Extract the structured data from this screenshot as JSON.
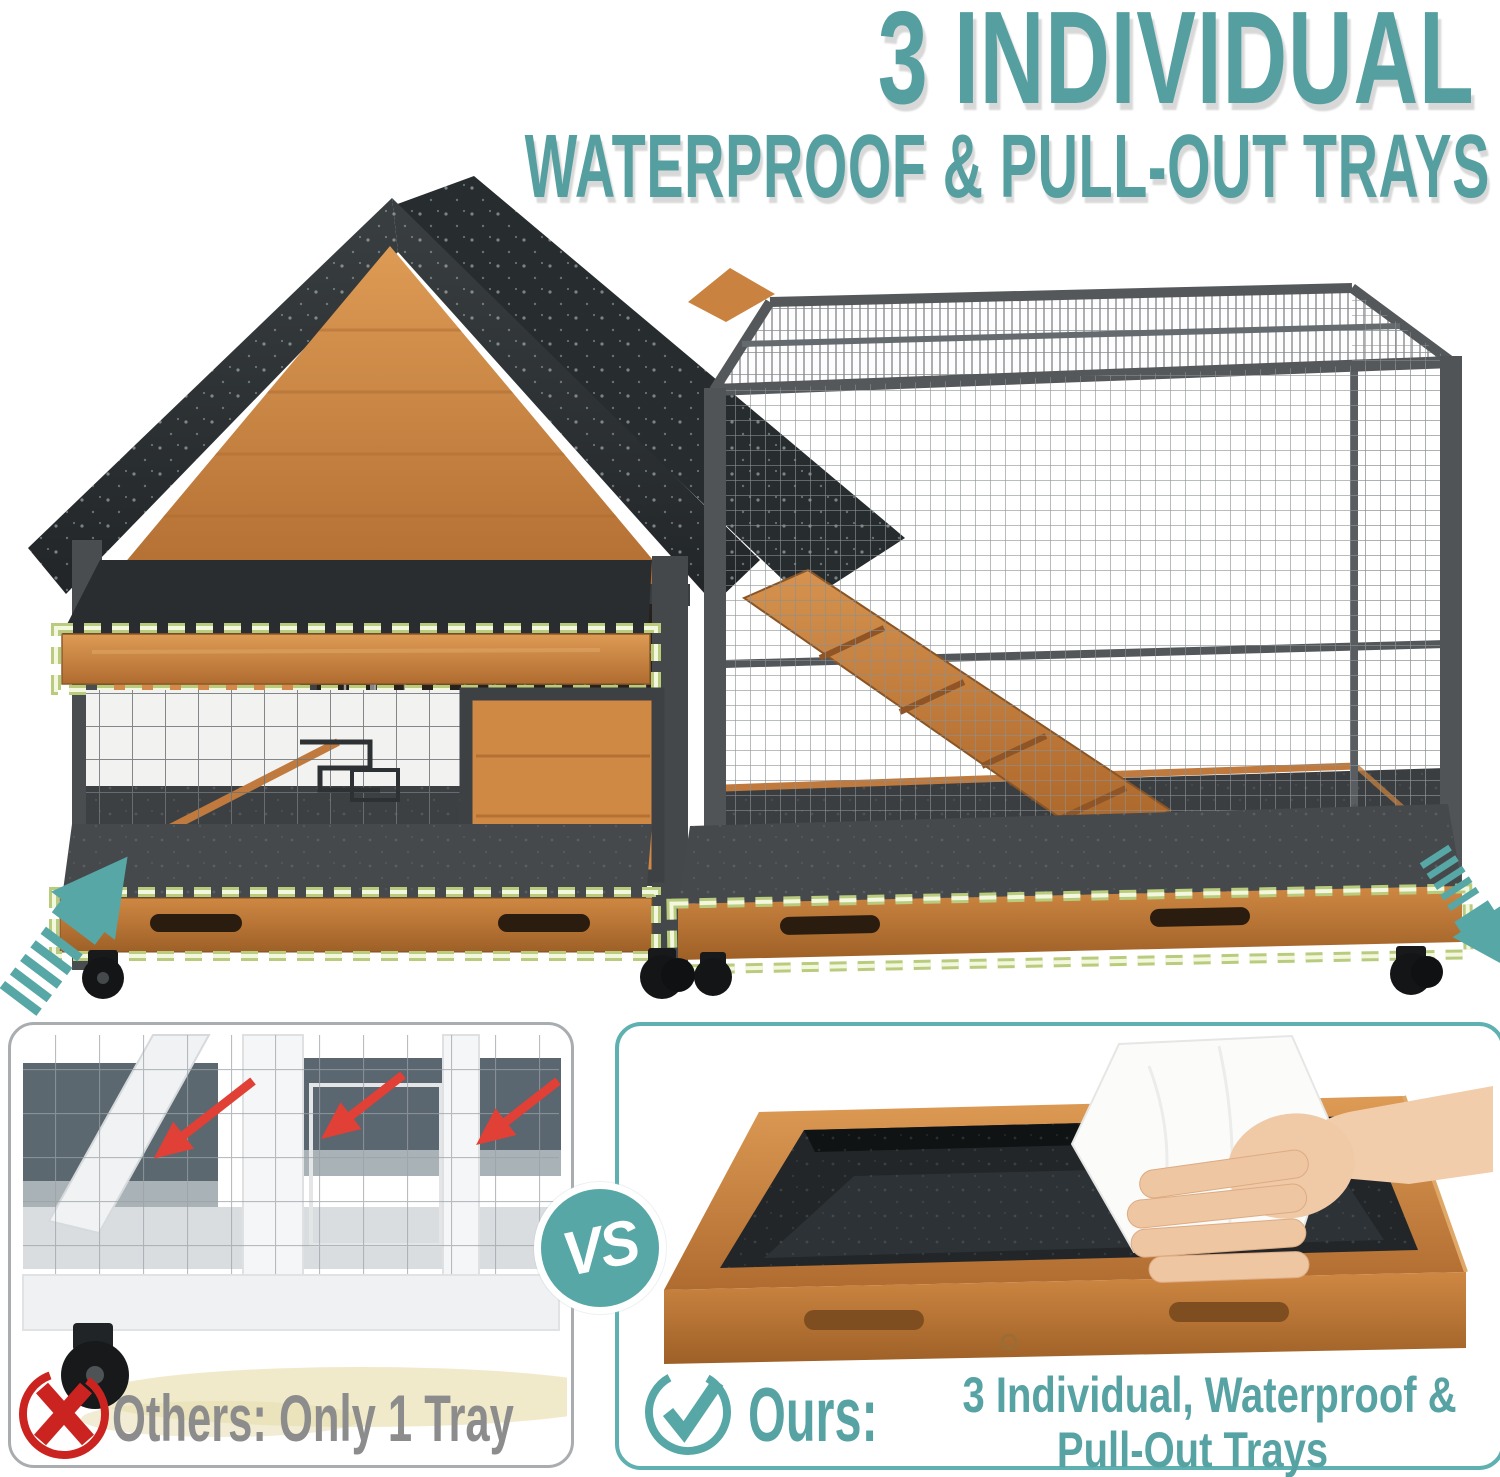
{
  "header": {
    "title_line1": "3 INDIVIDUAL",
    "title_line2": "WATERPROOF & PULL-OUT TRAYS"
  },
  "comparison": {
    "vs_label": "VS",
    "others": {
      "icon": "x-circle-icon",
      "label": "Others: Only 1 Tray"
    },
    "ours": {
      "icon": "check-circle-icon",
      "label": "Ours:",
      "description_line1": "3 Individual, Waterproof &",
      "description_line2": "Pull-Out Trays"
    }
  },
  "colors": {
    "accent_teal": "#57a3a4",
    "title_teal": "#569fa0",
    "wood_orange": "#cd8342",
    "roof_charcoal": "#2d3133",
    "frame_gray": "#4b4e50",
    "tray_dark": "#3c4042",
    "highlight_dash": "#dcecae",
    "error_red": "#cb2420",
    "muted_text_gray": "#8c8c8c",
    "spill_yellow": "#ece3b8"
  }
}
